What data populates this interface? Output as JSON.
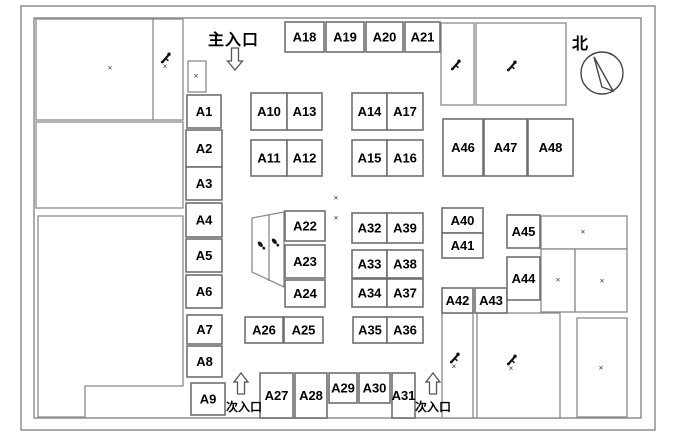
{
  "title": "Exhibition booth floor plan",
  "labels": {
    "main_entrance": "主入口",
    "side_entrance_left": "次入口",
    "side_entrance_right": "次入口",
    "north": "北"
  },
  "colors": {
    "wall_line": "#8a8a8a",
    "booth_line": "#6f6f6f",
    "text": "#000000"
  },
  "borders": {
    "outer": {
      "x": 21,
      "y": 6,
      "w": 634,
      "h": 424
    },
    "inner": {
      "x": 34,
      "y": 18,
      "w": 607,
      "h": 400
    }
  },
  "halls": [
    {
      "x": 36,
      "y": 19,
      "w": 147,
      "h": 101,
      "divider_x": 153
    },
    {
      "x": 36,
      "y": 122,
      "w": 147,
      "h": 86
    },
    {
      "x": 188,
      "y": 61,
      "w": 18,
      "h": 31
    },
    {
      "x": 441,
      "y": 23,
      "w": 33,
      "h": 82
    },
    {
      "x": 476,
      "y": 23,
      "w": 90,
      "h": 82
    },
    {
      "x": 541,
      "y": 216,
      "w": 86,
      "h": 33
    },
    {
      "x": 541,
      "y": 249,
      "w": 34,
      "h": 63
    },
    {
      "x": 575,
      "y": 249,
      "w": 52,
      "h": 63
    },
    {
      "x": 577,
      "y": 318,
      "w": 50,
      "h": 99
    },
    {
      "x": 442,
      "y": 313,
      "w": 31,
      "h": 105
    },
    {
      "x": 477,
      "y": 313,
      "w": 83,
      "h": 105
    }
  ],
  "l_region": {
    "points": "38,216 183,216 183,386 85,386 85,417 38,417"
  },
  "ramp": {
    "points": "252,218 284,212 284,287 252,272",
    "divider": {
      "x1": 269,
      "y1": 215,
      "x2": 269,
      "y2": 281
    }
  },
  "booths": [
    {
      "id": "A1",
      "x": 187,
      "y": 95,
      "w": 34,
      "h": 33
    },
    {
      "id": "A2",
      "x": 186,
      "y": 130,
      "w": 36,
      "h": 37
    },
    {
      "id": "A3",
      "x": 186,
      "y": 167,
      "w": 36,
      "h": 33
    },
    {
      "id": "A4",
      "x": 186,
      "y": 203,
      "w": 36,
      "h": 34
    },
    {
      "id": "A5",
      "x": 186,
      "y": 239,
      "w": 36,
      "h": 33
    },
    {
      "id": "A6",
      "x": 186,
      "y": 275,
      "w": 36,
      "h": 33
    },
    {
      "id": "A7",
      "x": 187,
      "y": 315,
      "w": 35,
      "h": 29
    },
    {
      "id": "A8",
      "x": 187,
      "y": 346,
      "w": 35,
      "h": 31
    },
    {
      "id": "A9",
      "x": 191,
      "y": 383,
      "w": 34,
      "h": 32
    },
    {
      "id": "A10",
      "x": 251,
      "y": 93,
      "w": 36,
      "h": 37
    },
    {
      "id": "A13",
      "x": 287,
      "y": 93,
      "w": 35,
      "h": 37
    },
    {
      "id": "A11",
      "x": 251,
      "y": 140,
      "w": 36,
      "h": 36
    },
    {
      "id": "A12",
      "x": 287,
      "y": 140,
      "w": 35,
      "h": 36
    },
    {
      "id": "A14",
      "x": 352,
      "y": 93,
      "w": 35,
      "h": 37
    },
    {
      "id": "A17",
      "x": 387,
      "y": 93,
      "w": 36,
      "h": 37
    },
    {
      "id": "A15",
      "x": 352,
      "y": 140,
      "w": 35,
      "h": 36
    },
    {
      "id": "A16",
      "x": 387,
      "y": 140,
      "w": 36,
      "h": 36
    },
    {
      "id": "A18",
      "x": 285,
      "y": 22,
      "w": 39,
      "h": 30
    },
    {
      "id": "A19",
      "x": 326,
      "y": 22,
      "w": 38,
      "h": 30
    },
    {
      "id": "A20",
      "x": 366,
      "y": 22,
      "w": 37,
      "h": 30
    },
    {
      "id": "A21",
      "x": 405,
      "y": 22,
      "w": 35,
      "h": 30
    },
    {
      "id": "A22",
      "x": 285,
      "y": 211,
      "w": 40,
      "h": 30
    },
    {
      "id": "A23",
      "x": 285,
      "y": 245,
      "w": 40,
      "h": 33
    },
    {
      "id": "A24",
      "x": 285,
      "y": 280,
      "w": 40,
      "h": 27
    },
    {
      "id": "A26",
      "x": 245,
      "y": 317,
      "w": 38,
      "h": 26
    },
    {
      "id": "A25",
      "x": 284,
      "y": 317,
      "w": 39,
      "h": 26
    },
    {
      "id": "A32",
      "x": 352,
      "y": 213,
      "w": 35,
      "h": 30
    },
    {
      "id": "A39",
      "x": 387,
      "y": 213,
      "w": 36,
      "h": 30
    },
    {
      "id": "A33",
      "x": 352,
      "y": 250,
      "w": 35,
      "h": 28
    },
    {
      "id": "A38",
      "x": 387,
      "y": 250,
      "w": 36,
      "h": 28
    },
    {
      "id": "A34",
      "x": 352,
      "y": 279,
      "w": 35,
      "h": 28
    },
    {
      "id": "A37",
      "x": 387,
      "y": 279,
      "w": 36,
      "h": 28
    },
    {
      "id": "A35",
      "x": 353,
      "y": 317,
      "w": 34,
      "h": 26
    },
    {
      "id": "A36",
      "x": 387,
      "y": 317,
      "w": 36,
      "h": 26
    },
    {
      "id": "A27",
      "x": 260,
      "y": 373,
      "w": 33,
      "h": 45
    },
    {
      "id": "A28",
      "x": 295,
      "y": 373,
      "w": 32,
      "h": 45
    },
    {
      "id": "A29",
      "x": 329,
      "y": 373,
      "w": 28,
      "h": 30
    },
    {
      "id": "A30",
      "x": 359,
      "y": 373,
      "w": 31,
      "h": 30
    },
    {
      "id": "A31",
      "x": 392,
      "y": 373,
      "w": 23,
      "h": 45
    },
    {
      "id": "A40",
      "x": 442,
      "y": 208,
      "w": 41,
      "h": 25
    },
    {
      "id": "A41",
      "x": 442,
      "y": 233,
      "w": 41,
      "h": 25
    },
    {
      "id": "A42",
      "x": 442,
      "y": 288,
      "w": 31,
      "h": 25
    },
    {
      "id": "A43",
      "x": 475,
      "y": 288,
      "w": 32,
      "h": 25
    },
    {
      "id": "A45",
      "x": 507,
      "y": 215,
      "w": 33,
      "h": 33
    },
    {
      "id": "A44",
      "x": 507,
      "y": 257,
      "w": 33,
      "h": 43
    },
    {
      "id": "A46",
      "x": 443,
      "y": 119,
      "w": 40,
      "h": 57
    },
    {
      "id": "A47",
      "x": 484,
      "y": 119,
      "w": 43,
      "h": 57
    },
    {
      "id": "A48",
      "x": 528,
      "y": 119,
      "w": 45,
      "h": 57
    }
  ],
  "marks": [
    {
      "x": 110,
      "y": 68
    },
    {
      "x": 196,
      "y": 76
    },
    {
      "x": 336,
      "y": 198
    },
    {
      "x": 336,
      "y": 218
    },
    {
      "x": 583,
      "y": 232
    },
    {
      "x": 558,
      "y": 280
    },
    {
      "x": 602,
      "y": 281
    },
    {
      "x": 601,
      "y": 368
    }
  ],
  "cart_icons": [
    {
      "x": 161,
      "y": 52,
      "mark": true
    },
    {
      "x": 451,
      "y": 59,
      "mark": false
    },
    {
      "x": 507,
      "y": 60,
      "mark": false
    },
    {
      "x": 450,
      "y": 352,
      "mark": true
    },
    {
      "x": 507,
      "y": 354,
      "mark": true
    }
  ],
  "footprints": [
    {
      "x": 261,
      "y": 245
    },
    {
      "x": 275,
      "y": 242
    }
  ],
  "arrows": [
    {
      "name": "main-entrance-arrow",
      "dir": "down",
      "cx": 235,
      "top": 48,
      "bottom": 70
    },
    {
      "name": "side-entrance-arrow-left",
      "dir": "up",
      "cx": 241,
      "top": 373,
      "bottom": 394
    },
    {
      "name": "side-entrance-arrow-right",
      "dir": "up",
      "cx": 433,
      "top": 373,
      "bottom": 394
    }
  ],
  "compass": {
    "cx": 602,
    "cy": 73,
    "r": 21,
    "needle": "594,57 613,91 602,87"
  }
}
